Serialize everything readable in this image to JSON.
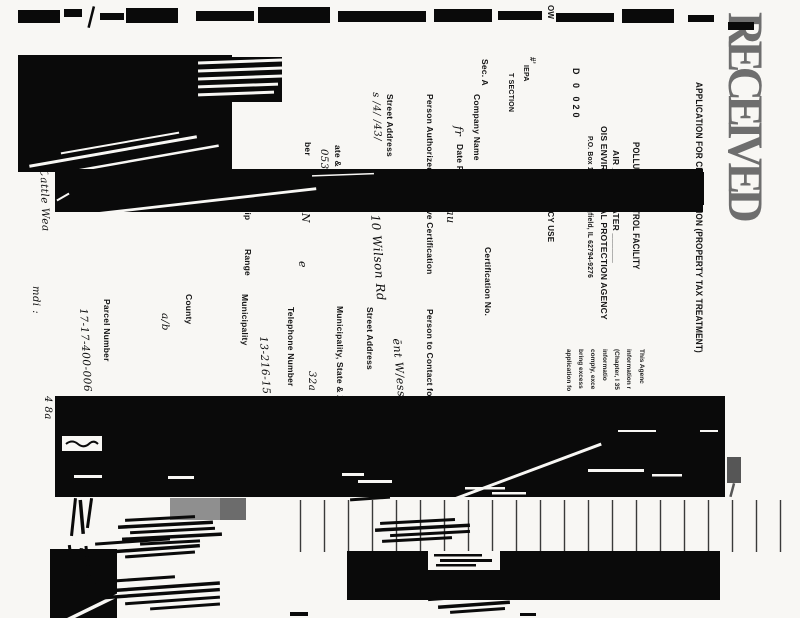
{
  "document": {
    "kind": "scanned form, rotated 90 degrees clockwise",
    "paper_color": "#f8f7f4",
    "ink_color": "#0a0a0a",
    "stamp_color": "#6e6e6e"
  },
  "texts": [
    {
      "name": "title-line-1",
      "text": "APPLICATION FOR CERTIFICATION (PROPERTY TAX TREATMENT)"
    },
    {
      "name": "title-line-2",
      "text": "POLLUTION CONTROL FACILITY"
    },
    {
      "name": "title-line-3",
      "text": "AIR ______  WATER ______"
    },
    {
      "name": "agency-line",
      "text": "OIS ENVIRONMENTAL PROTECTION AGENCY"
    },
    {
      "name": "po-box-line",
      "text": "P.O. Box 19276, Springfield, IL 62794-9276"
    },
    {
      "name": "stamp-digits",
      "text": "D 0 020"
    },
    {
      "name": "agency-use-box",
      "text": "AGCY USE"
    },
    {
      "name": "corner-ow",
      "text": "OW"
    },
    {
      "name": "corner-hash",
      "text": "#ʼ"
    },
    {
      "name": "corner-iepa",
      "text": "IEPA"
    },
    {
      "name": "corner-section",
      "text": "T SECTION"
    },
    {
      "name": "sec-a-label",
      "text": "Sec. A"
    },
    {
      "name": "company-name-label",
      "text": "Company Name"
    },
    {
      "name": "date-received-label",
      "text": "Date Re"
    },
    {
      "name": "person-authorized-label",
      "text": "Person Authorized to Receive Certification"
    },
    {
      "name": "person-contact-label",
      "text": "Person to Contact for Additional Information"
    },
    {
      "name": "street-address-label-1",
      "text": "Street Address"
    },
    {
      "name": "street-address-label-2",
      "text": "Street Address"
    },
    {
      "name": "zip-fragment",
      "text": "ate & Zi"
    },
    {
      "name": "municipality-zip-label",
      "text": "Municipality, State & Zip Code"
    },
    {
      "name": "number-fragment",
      "text": "ber"
    },
    {
      "name": "telephone-label",
      "text": "Telephone Number"
    },
    {
      "name": "township-fragment",
      "text": "ship"
    },
    {
      "name": "range-label",
      "text": "Range"
    },
    {
      "name": "municipality-label",
      "text": "Municipality"
    },
    {
      "name": "county-label",
      "text": "County"
    },
    {
      "name": "parcel-number-label",
      "text": "Parcel Number"
    },
    {
      "name": "certification-no-label",
      "text": "Certification No."
    },
    {
      "name": "fine-print-1",
      "text": "This Agenc"
    },
    {
      "name": "fine-print-2",
      "text": "information r"
    },
    {
      "name": "fine-print-3",
      "text": "(Chapter, I 35"
    },
    {
      "name": "fine-print-4",
      "text": "informatio"
    },
    {
      "name": "fine-print-5",
      "text": "comply, exce"
    },
    {
      "name": "fine-print-6",
      "text": "bring excess"
    },
    {
      "name": "fine-print-7",
      "text": "application fo"
    },
    {
      "name": "received-stamp",
      "text": "RECEIVED"
    },
    {
      "name": "hw-entry-street1",
      "text": "s /4/ /43/"
    },
    {
      "name": "hw-street-address",
      "text": "3110 Wilson Rd"
    },
    {
      "name": "hw-zip-053",
      "text": "053"
    },
    {
      "name": "hw-township-jn",
      "text": "J N"
    },
    {
      "name": "hw-range-e",
      "text": "e"
    },
    {
      "name": "hw-contact-street",
      "text": "ēnt W/ess"
    },
    {
      "name": "hw-32a",
      "text": "32a"
    },
    {
      "name": "hw-phone",
      "text": "13-216-15"
    },
    {
      "name": "hw-county",
      "text": "a/b"
    },
    {
      "name": "hw-parcel",
      "text": "17-17-400-006"
    },
    {
      "name": "hw-margin-note-1",
      "text": "of Bee Cattle Wea"
    },
    {
      "name": "hw-margin-note-2",
      "text": "mdi :"
    },
    {
      "name": "hw-margin-note-3",
      "text": "4 8a"
    },
    {
      "name": "hw-company-1",
      "text": "fr"
    },
    {
      "name": "hw-company-2",
      "text": "t au"
    }
  ]
}
